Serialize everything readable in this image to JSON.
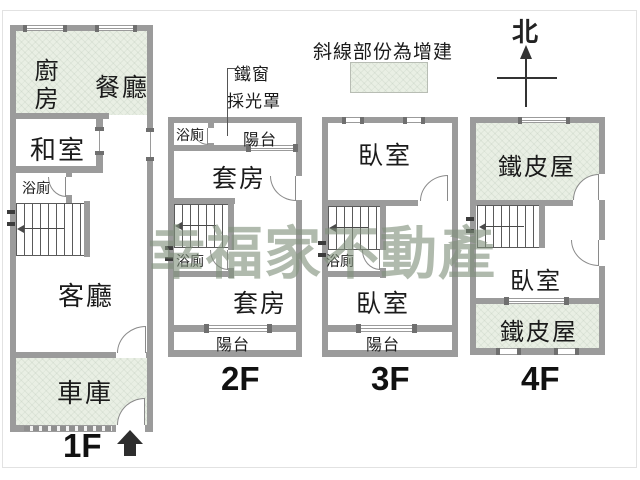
{
  "watermark": "幸福家不動產",
  "annotations": {
    "legend": "斜線部份為增建",
    "north": "北",
    "iron_window": "鐵窗",
    "light_canopy": "採光罩"
  },
  "colors": {
    "wall": "#9b9b9b",
    "addition_fill": "#e9efe4",
    "watermark": "rgba(128,144,122,0.62)",
    "entrance_arrow": "#2e2e2e"
  },
  "floors": [
    {
      "id": "1f",
      "label": "1F",
      "rooms": [
        {
          "key": "kitchen",
          "label": "廚房"
        },
        {
          "key": "dining",
          "label": "餐廳"
        },
        {
          "key": "tatami",
          "label": "和室"
        },
        {
          "key": "bath",
          "label": "浴廁"
        },
        {
          "key": "living",
          "label": "客廳"
        },
        {
          "key": "garage",
          "label": "車庫"
        }
      ]
    },
    {
      "id": "2f",
      "label": "2F",
      "rooms": [
        {
          "key": "bath-top",
          "label": "浴廁"
        },
        {
          "key": "balcony-top",
          "label": "陽台"
        },
        {
          "key": "suite-front",
          "label": "套房"
        },
        {
          "key": "bath-mid",
          "label": "浴廁"
        },
        {
          "key": "suite-rear",
          "label": "套房"
        },
        {
          "key": "balcony-bottom",
          "label": "陽台"
        }
      ]
    },
    {
      "id": "3f",
      "label": "3F",
      "rooms": [
        {
          "key": "bedroom-front",
          "label": "臥室"
        },
        {
          "key": "bath-mid",
          "label": "浴廁"
        },
        {
          "key": "bedroom-rear",
          "label": "臥室"
        },
        {
          "key": "balcony-bottom",
          "label": "陽台"
        }
      ]
    },
    {
      "id": "4f",
      "label": "4F",
      "rooms": [
        {
          "key": "metal-roof-front",
          "label": "鐵皮屋"
        },
        {
          "key": "bedroom",
          "label": "臥室"
        },
        {
          "key": "metal-roof-rear",
          "label": "鐵皮屋"
        }
      ]
    }
  ]
}
